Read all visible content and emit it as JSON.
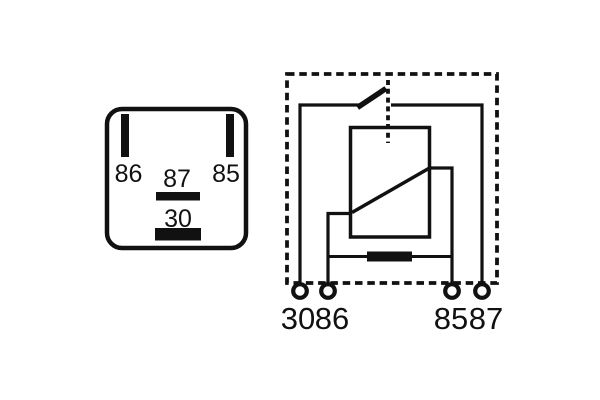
{
  "diagram": {
    "title": "Automotive relay pin layout and internal circuit diagram",
    "colors": {
      "line": "#111111",
      "background": "#ffffff"
    },
    "pinout": {
      "pin_86": "86",
      "pin_87": "87",
      "pin_85": "85",
      "pin_30": "30"
    },
    "schematic": {
      "terminal_30": "30",
      "terminal_86": "86",
      "terminal_85": "85",
      "terminal_87": "87"
    }
  }
}
